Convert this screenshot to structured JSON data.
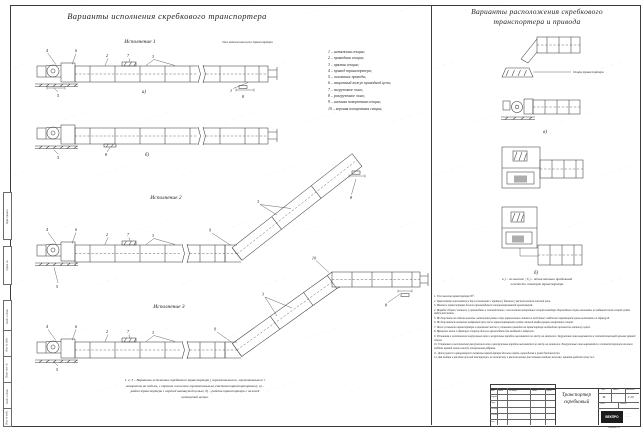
{
  "left_panel": {
    "title": "Варианты исполнения скребкового транспортера",
    "variants": {
      "v1": "Исполнение  1",
      "v2": "Исполнение  2",
      "v3": "Исполнение  3"
    },
    "tension_note": "Узел натяжения цепи транспортера",
    "legend": {
      "items": [
        "1  –   натяжная секция;",
        "2  –   приводная секция;",
        "3  –   прямая секция;",
        "4  –   привод транспортера;",
        "5  –   основание привода;",
        "6  –   защитный кожух приводной цепи;",
        "7  –   загрузочное окно;",
        "8  –   разгрузочное окно;",
        "9  –   нижняя поворотная секция;",
        "10 –   верхняя поворотная секция;"
      ]
    },
    "caption_line1": "1, 2, 3 – Варианты исполнения скребкового транспортера ( горизонтального,  горизонтального с",
    "caption_line2": "поворотом на подъем, с верхним и нижним горизонтальным участком транспортировки);  а) –",
    "caption_line3": "работ транспортера с верхней натянутой цепью;  б) –   работа транспортера с нижней",
    "caption_line4": "натянутой цепью."
  },
  "right_panel": {
    "title_line1": "Варианты расположения скребкового",
    "title_line2": "транспортера и привода",
    "support_label": "Опора транспортера",
    "caption_line1": "а ) –  по высоте ;  б ) –   относительно продольной",
    "caption_line2": "плоскости симетрии транспортера",
    "notes": [
      "1.  Угол наклона транспортера  30°.",
      "2.  Транспортер выполняется в двух исполнениях с крайним ( боковым ) расположением тяговой цепи.",
      "3.  Монтаж транспортера должен производиться специализированной организацией.",
      "4.  Порядок сборки ( монтаж ) производить в соответствии с положением поворотных секций конвейера. Переходные опоры выполнять по заданной схеме секций путём надёжной метки.",
      "5.  Не допускать на изделии вылеты, натяжение рамы в двух параллельных линиях по всей длине; надёжное перемещение рамы выполнять по образцу  В.",
      "6.  Не допускается изменение выбранной цепи после транспортировки путём сменной конфигурации поворотных секций.",
      "7.  После установки транспортера в проектное место и установки приводов на транспортере необходимо произвести затяжку цепей.",
      "8.  Вращение валов в обратную сторону должно происходить без заеданий и задержек.",
      "9.  Установка и изготовление загрузочных окон и загрузочных коробов выполняется по месту на монтаже. Загрузочные окна вырезаются в соответствующей крышке прямой секции.",
      "10.  Установка и изготовление разгрузочных окон и разгрузочных коробов выполняется по месту на монтаже. Разгрузочные окна вырезаются в соответствующем нижнем поддоне прямой секции между поперечными рёбрами.",
      "11.  Движущиеся и вращающиеся элементы транспортера должны иметь ограждения в целях безопасности.",
      "12.  Для выбора и расчёта нужной конструкции, по количеству и расположению рассчитаны вводные зажимы; принять рабочей схему №1."
    ]
  },
  "callouts": {
    "1": "1",
    "2": "2",
    "3": "3",
    "4": "4",
    "5": "5",
    "6": "6",
    "7": "7",
    "8": "8",
    "9": "9",
    "10": "10",
    "a": "а)",
    "b": "б)"
  },
  "title_block": {
    "doc_title_line1": "Транспортер",
    "doc_title_line2": "скребковый",
    "header_cells": [
      "Изм.",
      "Лист",
      "№ докум.",
      "Подп.",
      "Дата"
    ],
    "role_rows": [
      "Разраб.",
      "Пров.",
      "Т.контр.",
      "Н.контр.",
      "Утв."
    ],
    "col_lit": "Лит.",
    "col_mass": "Масса",
    "col_scale": "Масштаб",
    "lit_value": "М",
    "scale_value": "1:20",
    "sheet_label": "Лист",
    "sheets_label": "Листов",
    "logo_text": "ВЕКПРО",
    "format_label": "Формат А3"
  },
  "frame_labels": [
    "Перв. примен.",
    "Справ. №",
    "Подп. и дата",
    "Инв. № дубл.",
    "Взам. инв. №",
    "Подп. и дата",
    "Инв. № подл."
  ],
  "watermark": {
    "text": "~·~·~·~"
  }
}
